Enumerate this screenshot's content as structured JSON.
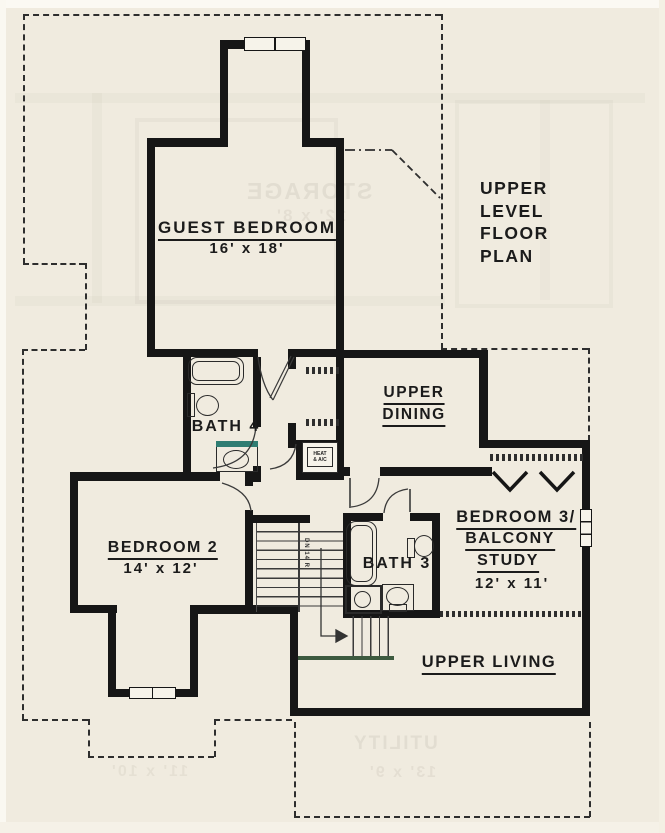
{
  "title": {
    "lines": [
      "UPPER",
      "LEVEL",
      "FLOOR",
      "PLAN"
    ]
  },
  "rooms": {
    "guest_bedroom": {
      "name": "GUEST BEDROOM",
      "dims": "16' x 18'"
    },
    "upper_dining": {
      "line1": "UPPER",
      "line2": "DINING"
    },
    "bath_4": {
      "name": "BATH 4"
    },
    "bedroom_2": {
      "name": "BEDROOM 2",
      "dims": "14' x 12'"
    },
    "bath_3": {
      "name": "BATH 3"
    },
    "bedroom_3": {
      "line1": "BEDROOM 3/",
      "line2": "BALCONY",
      "line3": "STUDY",
      "dims": "12' x 11'"
    },
    "upper_living": {
      "name": "UPPER LIVING"
    }
  },
  "annotations": {
    "hvac_line1": "HEAT",
    "hvac_line2": "& A/C",
    "stair_direction": "DN 14 R"
  },
  "ghost_bleed_text": {
    "storage": "STORAGE",
    "storage_dims": "12' x 8'",
    "utility": "UTILITY",
    "utility_dims": "13' x 9'",
    "bedroom_dims": "11' x 10'"
  },
  "colors": {
    "paper": "#f0ebdf",
    "wall": "#161616",
    "line": "#3a3a3a",
    "counter_teal": "#2f7d72",
    "stair_edge_green": "#3d5a3f"
  }
}
